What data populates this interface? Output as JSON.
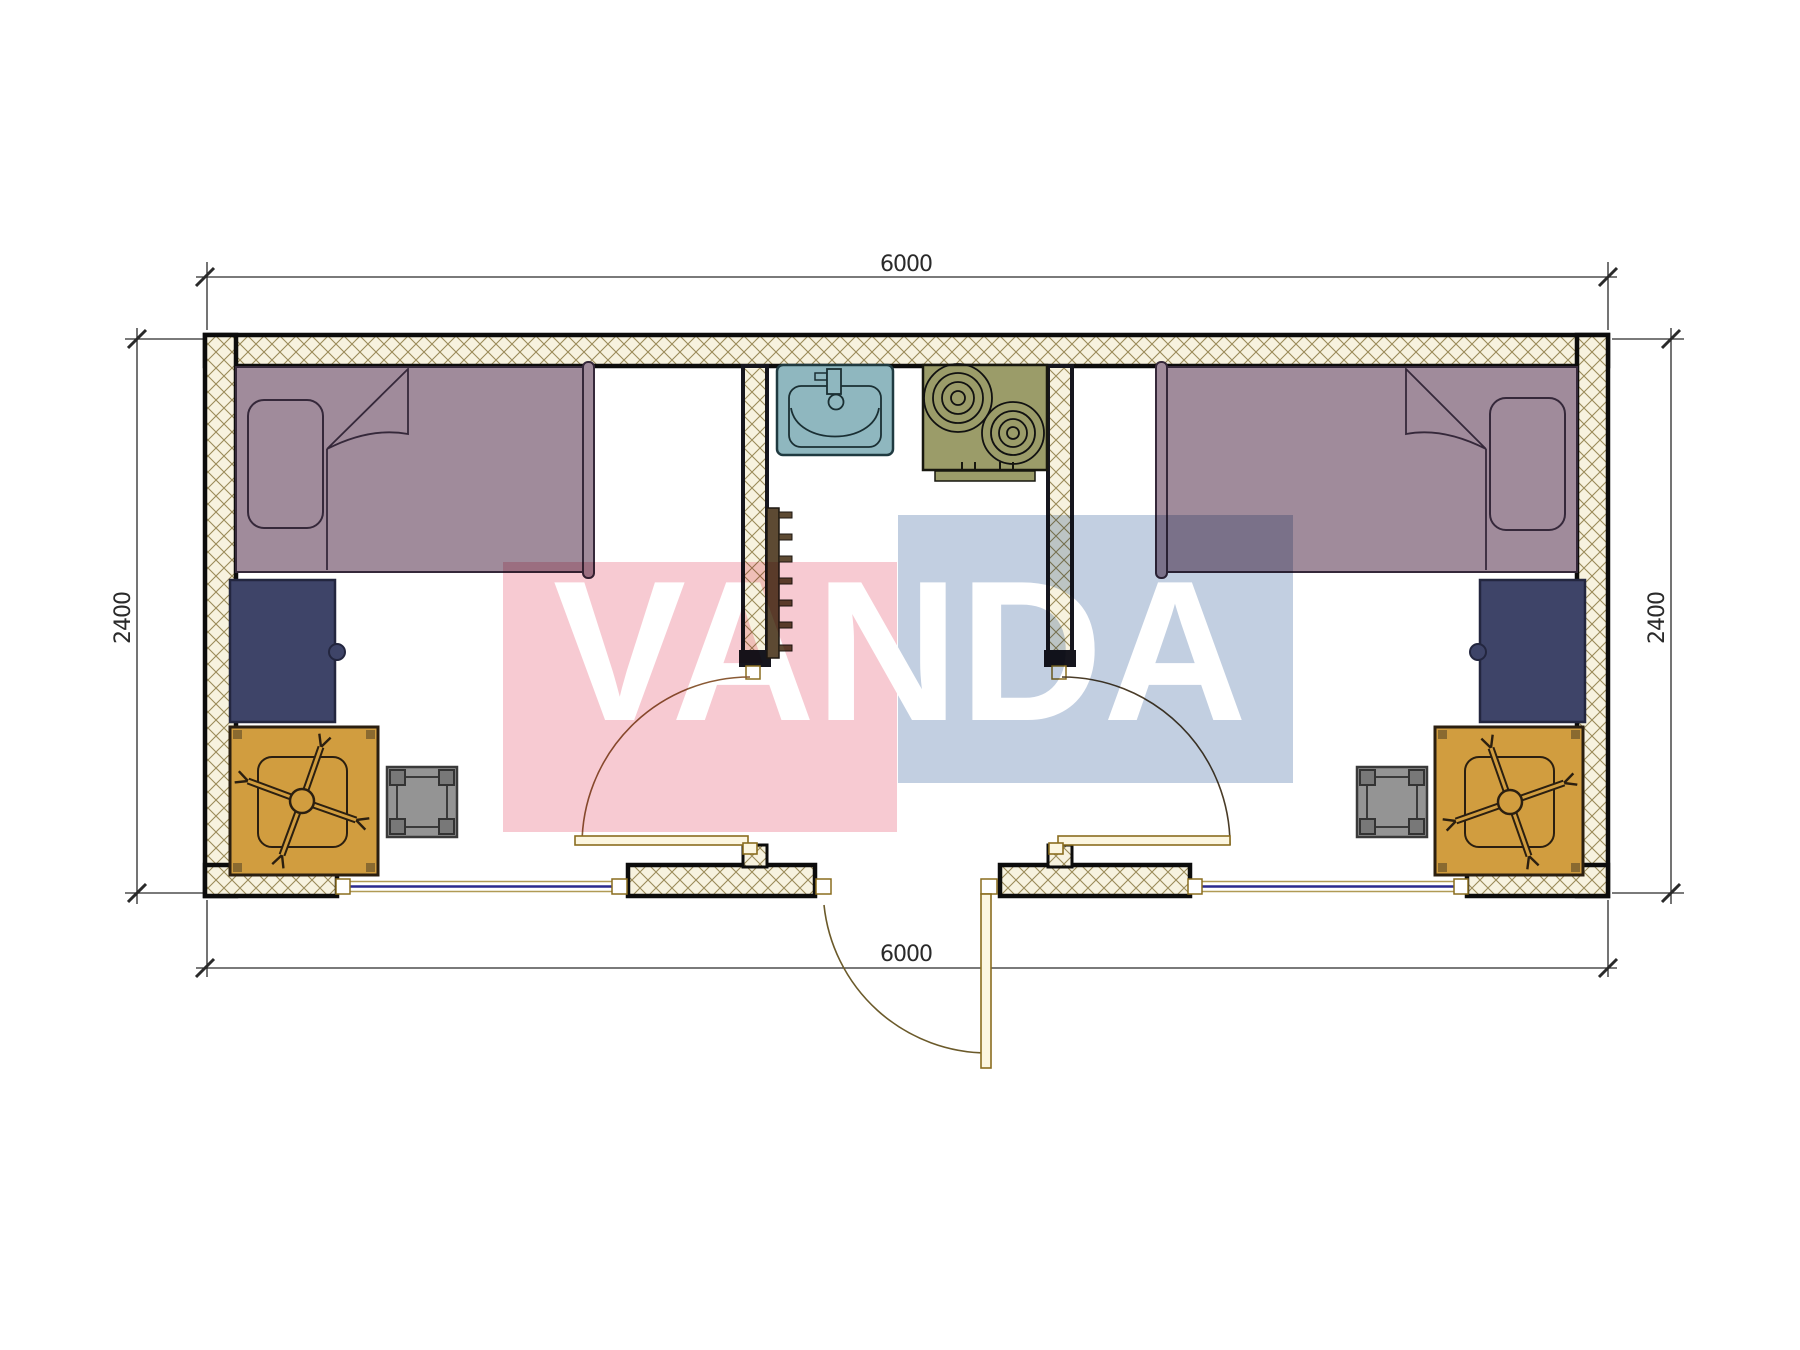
{
  "watermark": {
    "text": "VANDA",
    "pink_block_color": "rgba(222,45,75,0.25)",
    "blue_block_color": "rgba(95,130,175,0.38)",
    "letter_color": "#ffffff"
  },
  "dimensions": {
    "top": "6000",
    "bottom": "6000",
    "left": "2400",
    "right": "2400"
  },
  "palette": {
    "bed_fill": "#a08b9b",
    "bed_stroke": "#35283a",
    "desk_navy": "#3e4468",
    "desk_orange": "#d19d3f",
    "stool_gray": "#949494",
    "sink_teal": "#8fb7bf",
    "stove_olive": "#9b9c69",
    "rack_brown": "#5d4a33",
    "door_leaf_tan": "#fcf6e0",
    "arc_brown": "#8a5a35",
    "window_blue": "#2a2a8e",
    "wall_hatch_line": "#9a8a58",
    "wall_hatch_bg": "#f7f2df",
    "wall_border": "#0c0c0c",
    "dim_color": "#2a2a2a"
  },
  "plan": {
    "exterior_size_mm": {
      "width": 6000,
      "depth": 2400
    },
    "rooms": [
      "bedroom-left",
      "central-kitchen-hall",
      "bedroom-right"
    ],
    "furniture": [
      "single-bed-left",
      "single-bed-right",
      "pillow",
      "blanket-fold",
      "desk-navy-left",
      "desk-navy-right",
      "desk-orange-left",
      "desk-orange-right",
      "office-chair-left",
      "office-chair-right",
      "stool-left",
      "stool-right",
      "sink",
      "stove-two-burner",
      "coat-hook-rail",
      "interior-door-left",
      "interior-door-right",
      "entrance-door",
      "window-left",
      "window-right"
    ]
  }
}
